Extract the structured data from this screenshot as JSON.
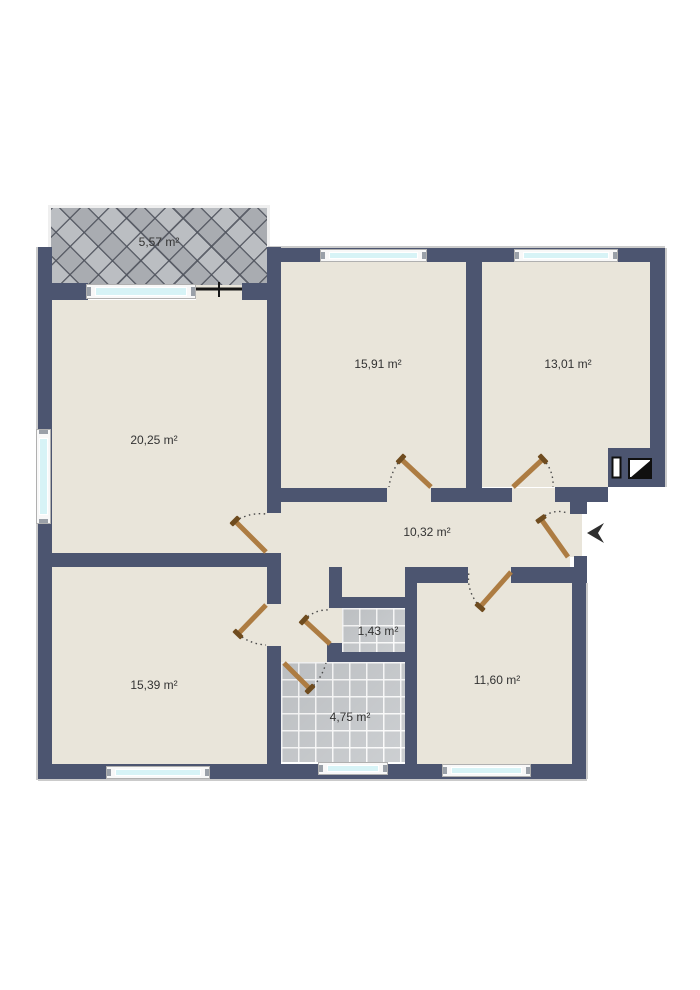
{
  "plan": {
    "type": "apartment-floor-plan",
    "unit": "m²",
    "total_rooms_labeled": 9
  },
  "rooms": [
    {
      "id": "balcony",
      "area": "5,57 m²"
    },
    {
      "id": "room-left-large",
      "area": "20,25 m²"
    },
    {
      "id": "room-top-middle",
      "area": "15,91 m²"
    },
    {
      "id": "room-top-right",
      "area": "13,01 m²"
    },
    {
      "id": "hallway",
      "area": "10,32 m²"
    },
    {
      "id": "room-bottom-left",
      "area": "15,39 m²"
    },
    {
      "id": "wc",
      "area": "1,43 m²"
    },
    {
      "id": "bathroom",
      "area": "4,75 m²"
    },
    {
      "id": "room-bottom-right",
      "area": "11,60 m²"
    }
  ],
  "symbols": [
    "entrance-arrow",
    "shaft-symbol-narrow",
    "shaft-symbol-half-filled",
    "balcony-door-line",
    "door-swing-arcs",
    "window-strips"
  ],
  "colors": {
    "wall": "#4c5570",
    "floor": "#e9e5da",
    "tile": "#c7cacd",
    "glass": "#d7f3f6",
    "balcony": "#b2b5ba",
    "door": "#ad7c42",
    "door_cap": "#6f4c1f",
    "label_text": "#333333",
    "arc": "#4a4a4a"
  }
}
